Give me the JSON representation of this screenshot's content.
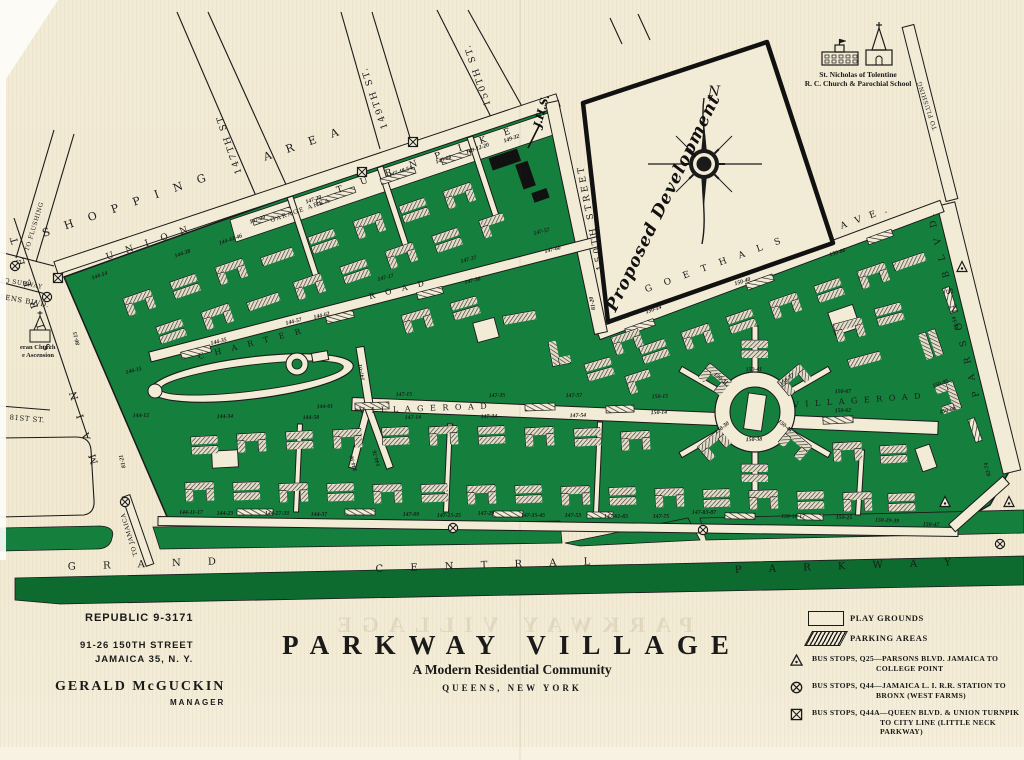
{
  "colors": {
    "paper": "#f2ebd6",
    "green": "#15803d",
    "dark_green": "#0d6b2f",
    "ink": "#1a1a1a",
    "building_base": "#f8f3e3",
    "building_fill": "#ddd6c2"
  },
  "footer": {
    "phone": "REPUBLIC 9-3171",
    "address_line1": "91-26 150TH STREET",
    "address_line2": "JAMAICA 35, N. Y.",
    "manager_name": "GERALD McGUCKIN",
    "manager_title": "MANAGER",
    "title": "PARKWAY VILLAGE",
    "subtitle": "A Modern Residential Community",
    "location": "QUEENS, NEW YORK",
    "ghost_text": "PARKWAY VILLAGE"
  },
  "legend": {
    "play": "PLAY GROUNDS",
    "parking": "PARKING AREAS",
    "q25_1": "BUS STOPS, Q25—PARSONS BLVD. JAMAICA TO",
    "q25_2": "COLLEGE POINT",
    "q44_1": "BUS STOPS, Q44—JAMAICA L. I. R.R. STATION TO",
    "q44_2": "BRONX (WEST FARMS)",
    "q44a_1": "BUS STOPS, Q44A—QUEEN BLVD. & UNION TURNPIK",
    "q44a_2": "TO CITY LINE (LITTLE NECK",
    "q44a_3": "PARKWAY)"
  },
  "map": {
    "landmarks": {
      "church_school_1": "St. Nicholas of Tolentine",
      "church_school_2": "R. C. Church & Parochial School",
      "left_church_1": "eran Church",
      "left_church_2": "e Ascension",
      "compass_n": "N",
      "proposed": "Proposed Development",
      "jhs": "J.H.S."
    },
    "streets": [
      {
        "t": "S H O P P I N G",
        "x": 128,
        "y": 208,
        "r": -19,
        "s": 11,
        "ls": 6
      },
      {
        "t": "A R E A",
        "x": 305,
        "y": 147,
        "r": -19,
        "s": 11,
        "ls": 6
      },
      {
        "t": "U N I O N",
        "x": 150,
        "y": 245,
        "r": -19,
        "s": 9,
        "ls": 5
      },
      {
        "t": "T U R N P I K E",
        "x": 428,
        "y": 162,
        "r": -19,
        "s": 9,
        "ls": 8
      },
      {
        "t": "GARAGE AREA",
        "x": 301,
        "y": 212,
        "r": -19,
        "s": 6,
        "ls": 1.5
      },
      {
        "t": "147TH ST.",
        "x": 231,
        "y": 142,
        "r": -109,
        "s": 9,
        "ls": 2
      },
      {
        "t": "149TH ST.",
        "x": 377,
        "y": 97,
        "r": -109,
        "s": 9,
        "ls": 2
      },
      {
        "t": "150TH ST.",
        "x": 480,
        "y": 74,
        "r": -109,
        "s": 9,
        "ls": 2
      },
      {
        "t": "150TH STREET",
        "x": 593,
        "y": 217,
        "r": -101,
        "s": 9,
        "ls": 3
      },
      {
        "t": "G O E T H A L S",
        "x": 716,
        "y": 267,
        "r": -20,
        "s": 9,
        "ls": 5
      },
      {
        "t": "A V E .",
        "x": 866,
        "y": 220,
        "r": -20,
        "s": 9,
        "ls": 3
      },
      {
        "t": "C H A R T E R",
        "x": 252,
        "y": 346,
        "r": -14,
        "s": 8,
        "ls": 4
      },
      {
        "t": "R O A D",
        "x": 399,
        "y": 292,
        "r": -14,
        "s": 8,
        "ls": 4
      },
      {
        "t": "V I L L A G E   R O A D",
        "x": 424,
        "y": 411,
        "r": -2,
        "s": 8,
        "ls": 2
      },
      {
        "t": "V I L L A G E   R O A D",
        "x": 858,
        "y": 403,
        "r": -4,
        "s": 8,
        "ls": 2
      },
      {
        "t": "M A I N",
        "x": 86,
        "y": 424,
        "r": -107,
        "s": 10,
        "ls": 6
      },
      {
        "t": "S T R E E T",
        "x": 33,
        "y": 290,
        "r": -107,
        "s": 10,
        "ls": 6
      },
      {
        "t": "EENS BLVD.",
        "x": 24,
        "y": 303,
        "r": 10,
        "s": 7,
        "ls": 0.5
      },
      {
        "t": "TO SUBWAY",
        "x": 21,
        "y": 285,
        "r": 10,
        "s": 6,
        "ls": 0.5
      },
      {
        "t": "81ST ST.",
        "x": 27,
        "y": 421,
        "r": 5,
        "s": 7,
        "ls": 0.5
      },
      {
        "t": "TO FLUSHING",
        "x": 36,
        "y": 227,
        "r": -73,
        "s": 6,
        "ls": 0.5
      },
      {
        "t": "TO FLUSHING",
        "x": 929,
        "y": 105,
        "r": -108,
        "s": 6,
        "ls": 0.5
      },
      {
        "t": "P A R S O N S   B L V D.",
        "x": 956,
        "y": 303,
        "r": -104,
        "s": 9,
        "ls": 4
      },
      {
        "t": "TO JAMAICA",
        "x": 131,
        "y": 534,
        "r": -107,
        "s": 6,
        "ls": 0.5
      },
      {
        "t": "G R A N D",
        "x": 148,
        "y": 567,
        "r": -2,
        "s": 10,
        "ls": 12
      },
      {
        "t": "C E N T R A L",
        "x": 489,
        "y": 568,
        "r": -2,
        "s": 10,
        "ls": 12
      },
      {
        "t": "P A R K W A Y",
        "x": 849,
        "y": 569,
        "r": -2,
        "s": 10,
        "ls": 12
      }
    ],
    "addresses": [
      {
        "t": "144-14",
        "x": 100,
        "y": 277,
        "r": -19
      },
      {
        "t": "144-38",
        "x": 183,
        "y": 255,
        "r": -19
      },
      {
        "t": "144-42-46",
        "x": 231,
        "y": 241,
        "r": -19
      },
      {
        "t": "147-20",
        "x": 258,
        "y": 221,
        "r": -19
      },
      {
        "t": "147-30",
        "x": 314,
        "y": 201,
        "r": -19
      },
      {
        "t": "147-48-54",
        "x": 401,
        "y": 173,
        "r": -19
      },
      {
        "t": "149-08",
        "x": 444,
        "y": 161,
        "r": -19
      },
      {
        "t": "149-12-20",
        "x": 478,
        "y": 150,
        "r": -19
      },
      {
        "t": "149-32",
        "x": 512,
        "y": 140,
        "r": -19
      },
      {
        "t": "144-15",
        "x": 134,
        "y": 372,
        "r": -14
      },
      {
        "t": "144-35",
        "x": 219,
        "y": 343,
        "r": -14
      },
      {
        "t": "144-57",
        "x": 294,
        "y": 323,
        "r": -14
      },
      {
        "t": "144-62",
        "x": 322,
        "y": 317,
        "r": -14
      },
      {
        "t": "147-17",
        "x": 386,
        "y": 279,
        "r": -14
      },
      {
        "t": "147-37",
        "x": 469,
        "y": 261,
        "r": -14
      },
      {
        "t": "147-38",
        "x": 473,
        "y": 282,
        "r": -14
      },
      {
        "t": "147-57",
        "x": 542,
        "y": 233,
        "r": -14
      },
      {
        "t": "147-60",
        "x": 553,
        "y": 251,
        "r": -14
      },
      {
        "t": "150-02-06",
        "x": 618,
        "y": 321,
        "r": -19
      },
      {
        "t": "150-14",
        "x": 654,
        "y": 311,
        "r": -19
      },
      {
        "t": "80-15",
        "x": 78,
        "y": 338,
        "r": -104
      },
      {
        "t": "81-21",
        "x": 124,
        "y": 461,
        "r": -104
      },
      {
        "t": "147-01",
        "x": 363,
        "y": 372,
        "r": -101
      },
      {
        "t": "144-90",
        "x": 355,
        "y": 463,
        "r": -104
      },
      {
        "t": "144-76",
        "x": 378,
        "y": 458,
        "r": -104
      },
      {
        "t": "81-20",
        "x": 594,
        "y": 303,
        "r": -101
      },
      {
        "t": "82-54",
        "x": 957,
        "y": 323,
        "r": -104
      },
      {
        "t": "82-74",
        "x": 989,
        "y": 469,
        "r": -104
      },
      {
        "t": "144-12",
        "x": 141,
        "y": 417,
        "r": -2
      },
      {
        "t": "144-34",
        "x": 225,
        "y": 418,
        "r": -2
      },
      {
        "t": "144-58",
        "x": 311,
        "y": 419,
        "r": -2
      },
      {
        "t": "144-61",
        "x": 325,
        "y": 408,
        "r": -2
      },
      {
        "t": "147-15",
        "x": 404,
        "y": 396,
        "r": -2
      },
      {
        "t": "147-35",
        "x": 497,
        "y": 397,
        "r": -2
      },
      {
        "t": "147-57",
        "x": 574,
        "y": 397,
        "r": -2
      },
      {
        "t": "150-15",
        "x": 660,
        "y": 398,
        "r": -2
      },
      {
        "t": "147-14",
        "x": 413,
        "y": 419,
        "r": -2
      },
      {
        "t": "147-34",
        "x": 489,
        "y": 418,
        "r": -2
      },
      {
        "t": "147-54",
        "x": 578,
        "y": 417,
        "r": -2
      },
      {
        "t": "150-14",
        "x": 659,
        "y": 414,
        "r": -2
      },
      {
        "t": "144-11-17",
        "x": 191,
        "y": 514,
        "r": 0
      },
      {
        "t": "144-23",
        "x": 225,
        "y": 515,
        "r": 0
      },
      {
        "t": "144-27-33",
        "x": 277,
        "y": 515,
        "r": 0
      },
      {
        "t": "144-37",
        "x": 319,
        "y": 516,
        "r": 0
      },
      {
        "t": "147-09",
        "x": 411,
        "y": 516,
        "r": 0
      },
      {
        "t": "147-15-25",
        "x": 449,
        "y": 517,
        "r": 0
      },
      {
        "t": "147-29",
        "x": 486,
        "y": 515,
        "r": 0
      },
      {
        "t": "147-35-45",
        "x": 533,
        "y": 517,
        "r": 0
      },
      {
        "t": "147-53",
        "x": 573,
        "y": 517,
        "r": 0
      },
      {
        "t": "147-61-65",
        "x": 616,
        "y": 518,
        "r": 0
      },
      {
        "t": "147-75",
        "x": 661,
        "y": 518,
        "r": 0
      },
      {
        "t": "147-83-87",
        "x": 704,
        "y": 514,
        "r": 0
      },
      {
        "t": "150-11-17",
        "x": 793,
        "y": 518,
        "r": 1
      },
      {
        "t": "150-25",
        "x": 844,
        "y": 519,
        "r": 2
      },
      {
        "t": "150-29-39",
        "x": 887,
        "y": 522,
        "r": 3
      },
      {
        "t": "150-47",
        "x": 931,
        "y": 526,
        "r": 3
      },
      {
        "t": "150-40",
        "x": 743,
        "y": 283,
        "r": -18
      },
      {
        "t": "150-66",
        "x": 838,
        "y": 254,
        "r": -18
      },
      {
        "t": "150-41",
        "x": 754,
        "y": 371,
        "r": -2
      },
      {
        "t": "150-31",
        "x": 720,
        "y": 380,
        "r": 38
      },
      {
        "t": "150-37",
        "x": 788,
        "y": 381,
        "r": -38
      },
      {
        "t": "150-30",
        "x": 723,
        "y": 429,
        "r": -38
      },
      {
        "t": "150-38",
        "x": 754,
        "y": 441,
        "r": -2
      },
      {
        "t": "150-46",
        "x": 784,
        "y": 427,
        "r": 38
      },
      {
        "t": "150-67",
        "x": 843,
        "y": 393,
        "r": -2
      },
      {
        "t": "150-62",
        "x": 843,
        "y": 412,
        "r": -2
      },
      {
        "t": "150-95",
        "x": 941,
        "y": 385,
        "r": -20
      },
      {
        "t": "150-90",
        "x": 948,
        "y": 412,
        "r": -12
      }
    ],
    "bus_stops": [
      {
        "k": "circle-x",
        "x": 15,
        "y": 266
      },
      {
        "k": "square-x",
        "x": 58,
        "y": 278
      },
      {
        "k": "circle-x",
        "x": 47,
        "y": 297
      },
      {
        "k": "square-x",
        "x": 362,
        "y": 172
      },
      {
        "k": "square-x",
        "x": 413,
        "y": 142
      },
      {
        "k": "circle-x",
        "x": 125,
        "y": 502
      },
      {
        "k": "circle-x",
        "x": 453,
        "y": 528
      },
      {
        "k": "circle-x",
        "x": 703,
        "y": 530
      },
      {
        "k": "circle-x",
        "x": 1000,
        "y": 544
      },
      {
        "k": "triangle",
        "x": 962,
        "y": 267
      },
      {
        "k": "triangle",
        "x": 945,
        "y": 502
      },
      {
        "k": "triangle",
        "x": 1009,
        "y": 502
      }
    ]
  }
}
